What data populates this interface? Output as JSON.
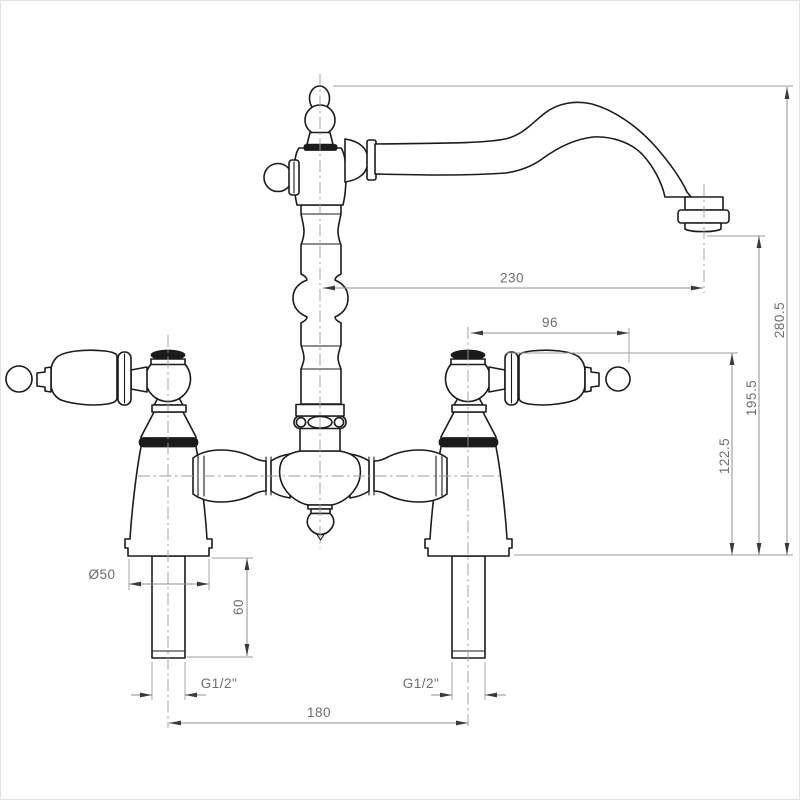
{
  "drawing": {
    "subject": "bridge-mixer-tap-front-elevation",
    "background": "#ffffff",
    "outline_color": "#1b1b1b",
    "dimension_line_color": "#8f8f8f",
    "dimension_text_color": "#6d6d6d",
    "centerline_color": "#9c9c9c",
    "dimensions": {
      "spout_reach": "230",
      "overall_height": "280.5",
      "handle_length": "96",
      "spout_outlet_height": "195.5",
      "handle_top_height": "122.5",
      "base_diameter": "Ø50",
      "shank_length": "60",
      "inlet_thread_left": "G1/2\"",
      "inlet_thread_right": "G1/2\"",
      "inlet_centres": "180"
    }
  }
}
